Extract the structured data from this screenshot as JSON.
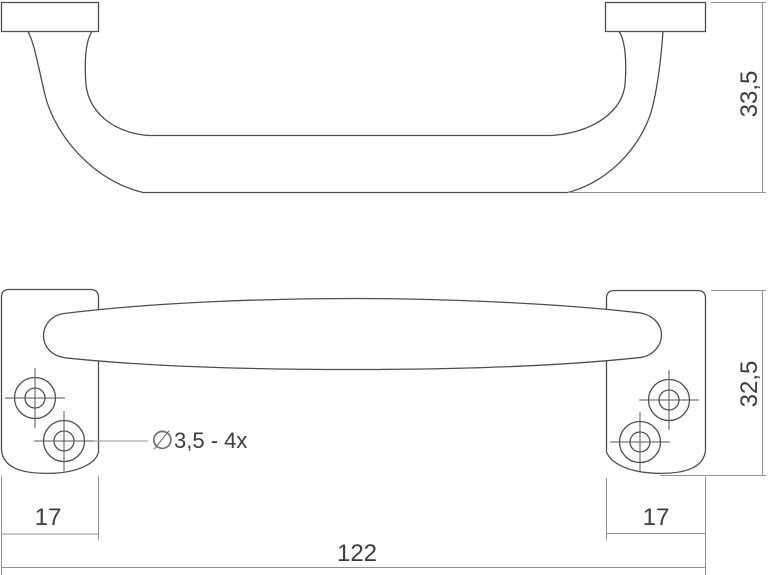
{
  "drawing": {
    "side_view": {
      "height_label": "33,5"
    },
    "front_view": {
      "height_label": "32,5",
      "left_plate_width_label": "17",
      "right_plate_width_label": "17",
      "total_width_label": "122",
      "hole_callout_symbol": "∅",
      "hole_callout_text": "3,5 - 4x"
    },
    "colors": {
      "background": "#ffffff",
      "object_outline": "#4f4f4f",
      "dimension_line": "#919191",
      "label_text": "#3d3d3d"
    }
  }
}
